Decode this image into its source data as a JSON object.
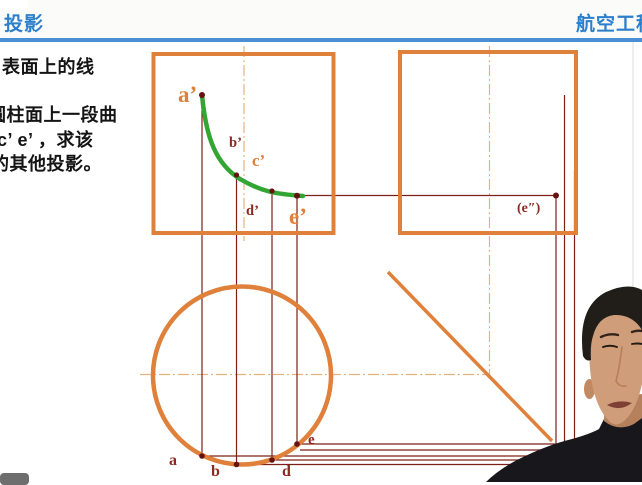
{
  "header": {
    "left_title": "投影",
    "right_title": "航空工程"
  },
  "slide": {
    "heading": "表面上的线",
    "body_lines": [
      "圆柱面上一段曲",
      "c’ e’ ，求该",
      "的其他投影。"
    ]
  },
  "diagram": {
    "labels": {
      "a_front": "a’",
      "b_front": "b’",
      "c_front": "c’",
      "d_front": "d’",
      "e_front": "e’",
      "e_side": "(e″)",
      "a_top": "a",
      "b_top": "b",
      "d_top": "d",
      "e_top": "e"
    }
  },
  "colors": {
    "accent_blue": "#2B7FCB",
    "header_rule_blue": "#4A8FD3",
    "outline_orange": "#E0813B",
    "projection_maroon": "#7E2018",
    "label_maroon": "#8B2A20",
    "curve_green": "#33A532",
    "centerline_tan": "#E3B37E",
    "shirt_dark": "#17171C",
    "skin": "#CF9D79"
  }
}
